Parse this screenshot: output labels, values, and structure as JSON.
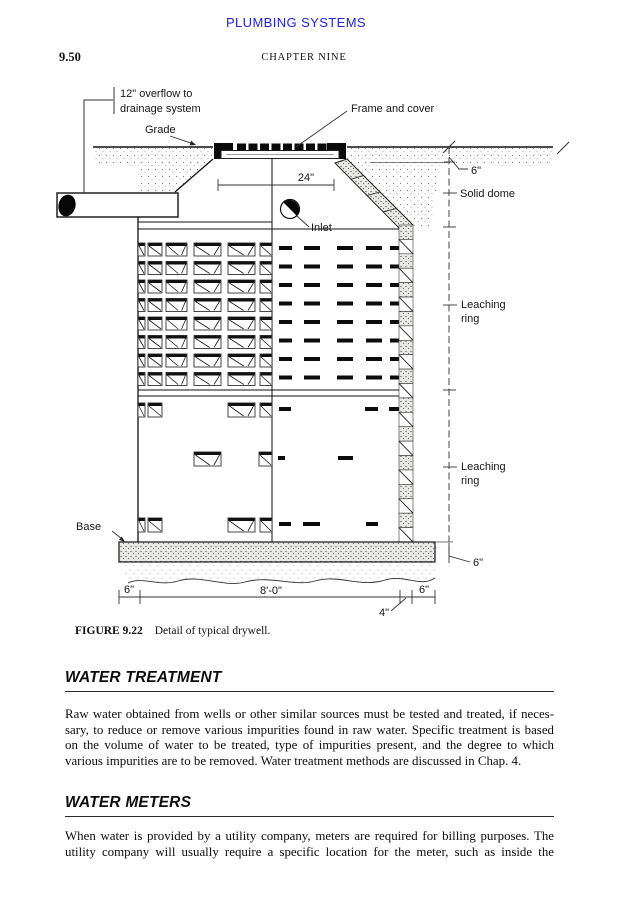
{
  "page": {
    "running_head": "PLUMBING SYSTEMS",
    "folio": "9.50",
    "chapter_head": "CHAPTER NINE",
    "head_color": "#2222dd"
  },
  "figure": {
    "caption_label": "FIGURE 9.22",
    "caption_text": "Detail of typical drywell.",
    "labels": {
      "overflow_line1": "12\" overflow to",
      "overflow_line2": "drainage system",
      "frame_cover": "Frame and cover",
      "grade": "Grade",
      "dim_24": "24\"",
      "dim_6_top": "6\"",
      "solid_dome": "Solid dome",
      "inlet": "Inlet",
      "leaching_1a": "Leaching",
      "leaching_1b": "ring",
      "leaching_2a": "Leaching",
      "leaching_2b": "ring",
      "base": "Base",
      "dim_6_bottom_left": "6\"",
      "dim_8ft": "8'-0\"",
      "dim_4": "4\"",
      "dim_6_bottom_right": "6\"",
      "dim_6_base": "6\""
    },
    "grid": {
      "upper": {
        "rows": [
          243,
          261.5,
          280,
          298.5,
          317,
          335.5,
          354,
          372.5
        ],
        "blocks": [
          [
            138,
            7
          ],
          [
            148,
            14
          ],
          [
            166,
            21
          ],
          [
            194,
            27
          ],
          [
            228,
            27
          ],
          [
            260,
            12
          ]
        ],
        "dashes": [
          [
            279,
            13
          ],
          [
            304,
            16
          ],
          [
            337,
            16
          ],
          [
            366,
            16
          ],
          [
            390,
            12
          ]
        ]
      },
      "lower": [
        {
          "y": 403,
          "blocks": [
            [
              138,
              7
            ],
            [
              148,
              14
            ],
            [
              228,
              27
            ],
            [
              260,
              12
            ]
          ],
          "dashes": [
            [
              279,
              12
            ],
            [
              365,
              13
            ],
            [
              389,
              13
            ]
          ]
        },
        {
          "y": 452,
          "blocks": [
            [
              194,
              27
            ],
            [
              259,
              13
            ]
          ],
          "dashes": [
            [
              278,
              7
            ],
            [
              338,
              15
            ]
          ]
        },
        {
          "y": 518,
          "blocks": [
            [
              138,
              7
            ],
            [
              148,
              14
            ],
            [
              228,
              27
            ],
            [
              260,
              12
            ]
          ],
          "dashes": [
            [
              279,
              12
            ],
            [
              303,
              17
            ],
            [
              366,
              12
            ]
          ]
        }
      ],
      "wall": {
        "x": 399,
        "w": 14,
        "top": 225,
        "bottom": 542,
        "cells": 22
      }
    }
  },
  "sections": [
    {
      "heading": "WATER TREATMENT",
      "lines": [
        "Raw water obtained from wells or other similar sources must be tested and treated, if neces-",
        "sary, to reduce or remove various impurities found in raw water. Specific treatment is based",
        "on the volume of water to be treated, type of impurities present, and the degree to which",
        "various impurities are to be removed. Water treatment methods are discussed in Chap. 4."
      ]
    },
    {
      "heading": "WATER METERS",
      "lines": [
        "When water is provided by a utility company, meters are required for billing purposes. The",
        "utility company will usually require a specific location for the meter, such as inside the"
      ]
    }
  ]
}
